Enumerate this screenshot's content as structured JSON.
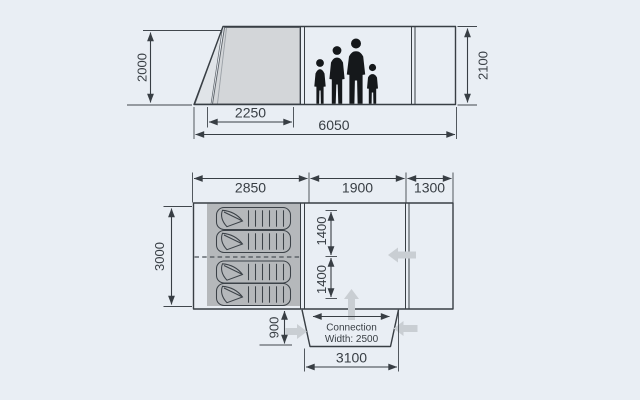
{
  "diagram_title": "Tent dimensions drawing (side view and floor plan)",
  "colors": {
    "background": "#e9eef4",
    "line": "#383e44",
    "door_panel": "#d3d6d9",
    "door_panel_light": "#e0e4e8",
    "sleeping_area": "#b5b8bb",
    "silhouette": "#15181b",
    "direction_arrow": "#c9ced3"
  },
  "side_view": {
    "height_left": "2000",
    "height_right": "2100",
    "front_section_width": "2250",
    "total_width": "6050"
  },
  "floor_plan": {
    "sleeping_section_width": "2850",
    "living_section_width": "1900",
    "canopy_section_width": "1300",
    "depth": "3000",
    "cabin_width_top": "1400",
    "cabin_width_bottom": "1400",
    "tunnel_depth": "900",
    "connection_label_line1": "Connection",
    "connection_label_line2": "Width: 2500",
    "tunnel_outer_width": "3100"
  }
}
